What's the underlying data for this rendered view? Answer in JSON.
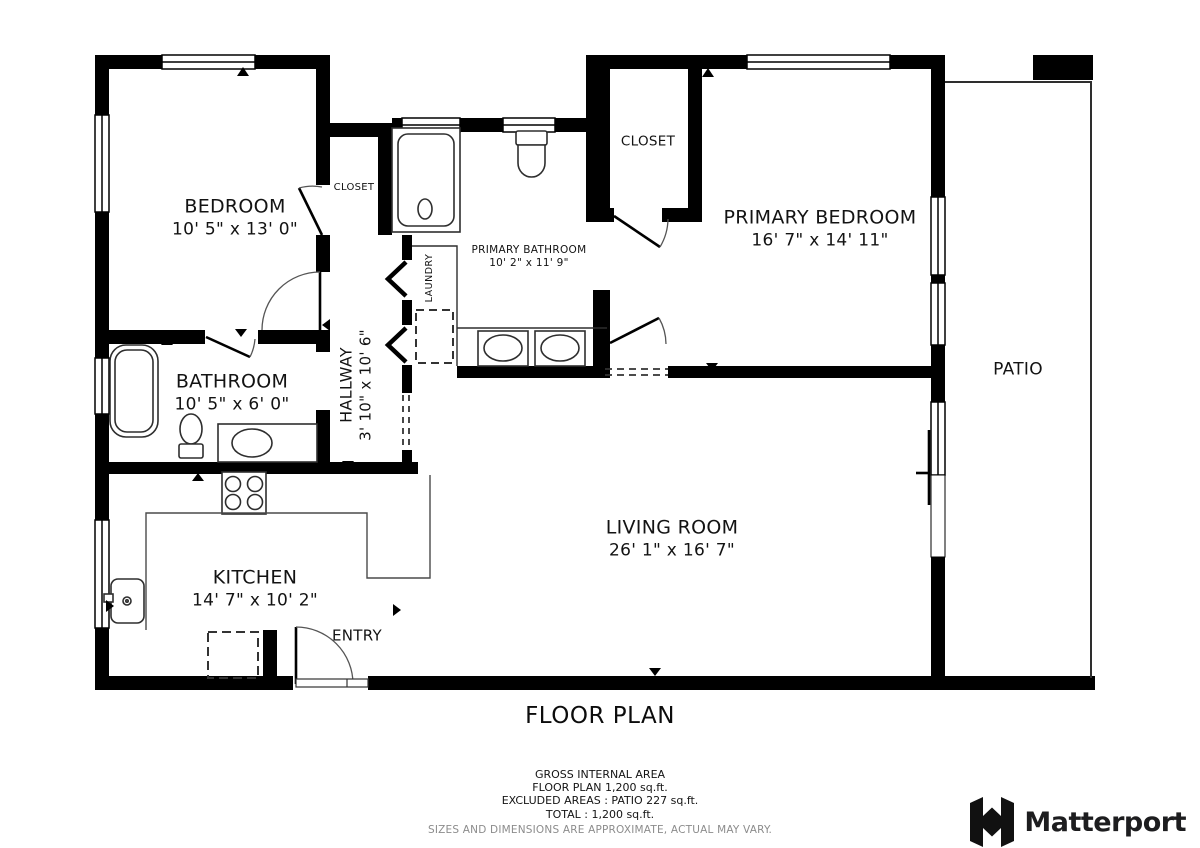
{
  "title": "FLOOR PLAN",
  "rooms": {
    "bedroom": {
      "label": "BEDROOM",
      "dims": "10' 5\" x 13' 0\""
    },
    "closet_bedroom": {
      "label": "CLOSET"
    },
    "primary_bathroom": {
      "label": "PRIMARY BATHROOM",
      "dims": "10' 2\" x 11' 9\""
    },
    "closet_primary": {
      "label": "CLOSET"
    },
    "primary_bedroom": {
      "label": "PRIMARY BEDROOM",
      "dims": "16' 7\" x 14' 11\""
    },
    "patio": {
      "label": "PATIO"
    },
    "bathroom": {
      "label": "BATHROOM",
      "dims": "10' 5\" x 6' 0\""
    },
    "hallway": {
      "label": "HALLWAY",
      "dims": "3' 10\" x 10' 6\""
    },
    "laundry": {
      "label": "LAUNDRY"
    },
    "kitchen": {
      "label": "KITCHEN",
      "dims": "14' 7\" x 10' 2\""
    },
    "living_room": {
      "label": "LIVING ROOM",
      "dims": "26' 1\" x 16' 7\""
    },
    "entry": {
      "label": "ENTRY"
    }
  },
  "footer": {
    "lines": [
      "GROSS INTERNAL AREA",
      "FLOOR PLAN 1,200 sq.ft.",
      "EXCLUDED AREAS :  PATIO 227 sq.ft.",
      "TOTAL :  1,200 sq.ft."
    ],
    "disclaimer": "SIZES AND DIMENSIONS ARE APPROXIMATE, ACTUAL MAY VARY.",
    "brand": "Matterport"
  },
  "colors": {
    "wall": "#000000",
    "fixture": "#2e2e2e",
    "counter": "#4a4a4a",
    "disclaimer_gray": "#8c8c8c",
    "brand_dark": "#1d1d1f",
    "background": "#ffffff"
  }
}
